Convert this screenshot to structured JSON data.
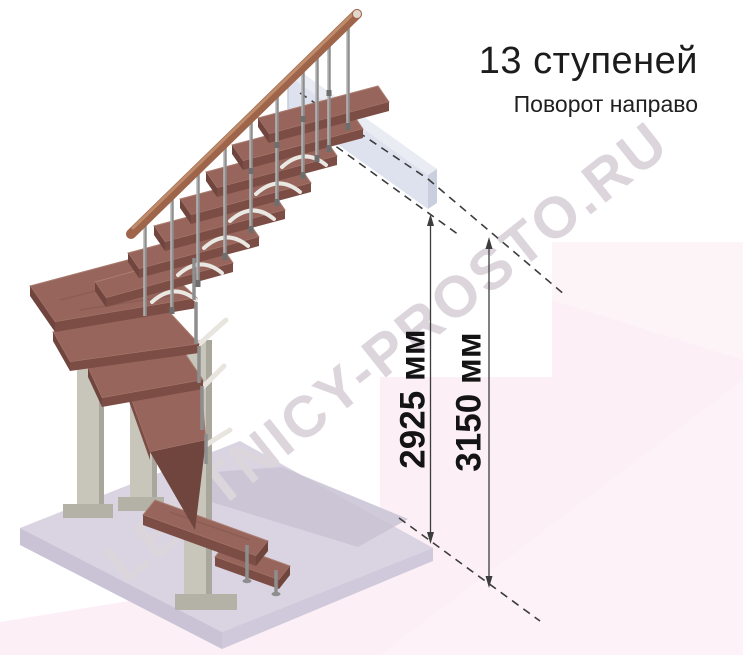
{
  "header": {
    "title": "13 ступеней",
    "subtitle": "Поворот направо"
  },
  "dimensions": {
    "inner": {
      "label": "2925 мм"
    },
    "outer": {
      "label": "3150 мм"
    }
  },
  "watermark": {
    "text": "LESTNICY-PROSTO.RU"
  },
  "diagram": {
    "steps_shown": 13,
    "turn": "направо"
  },
  "colors": {
    "tread_top": "#97655c",
    "tread_front": "#7b4d45",
    "metal_post": "#c8c5bb",
    "baluster": "#8e8e8e",
    "handrail": "#9f654a",
    "floor_top": "#d9d3e2",
    "landing_slab": "#dde2ee",
    "background_pink": "#fcf0f6",
    "dimension_lines": "#3d3d3d",
    "text": "#1c1c1c"
  }
}
